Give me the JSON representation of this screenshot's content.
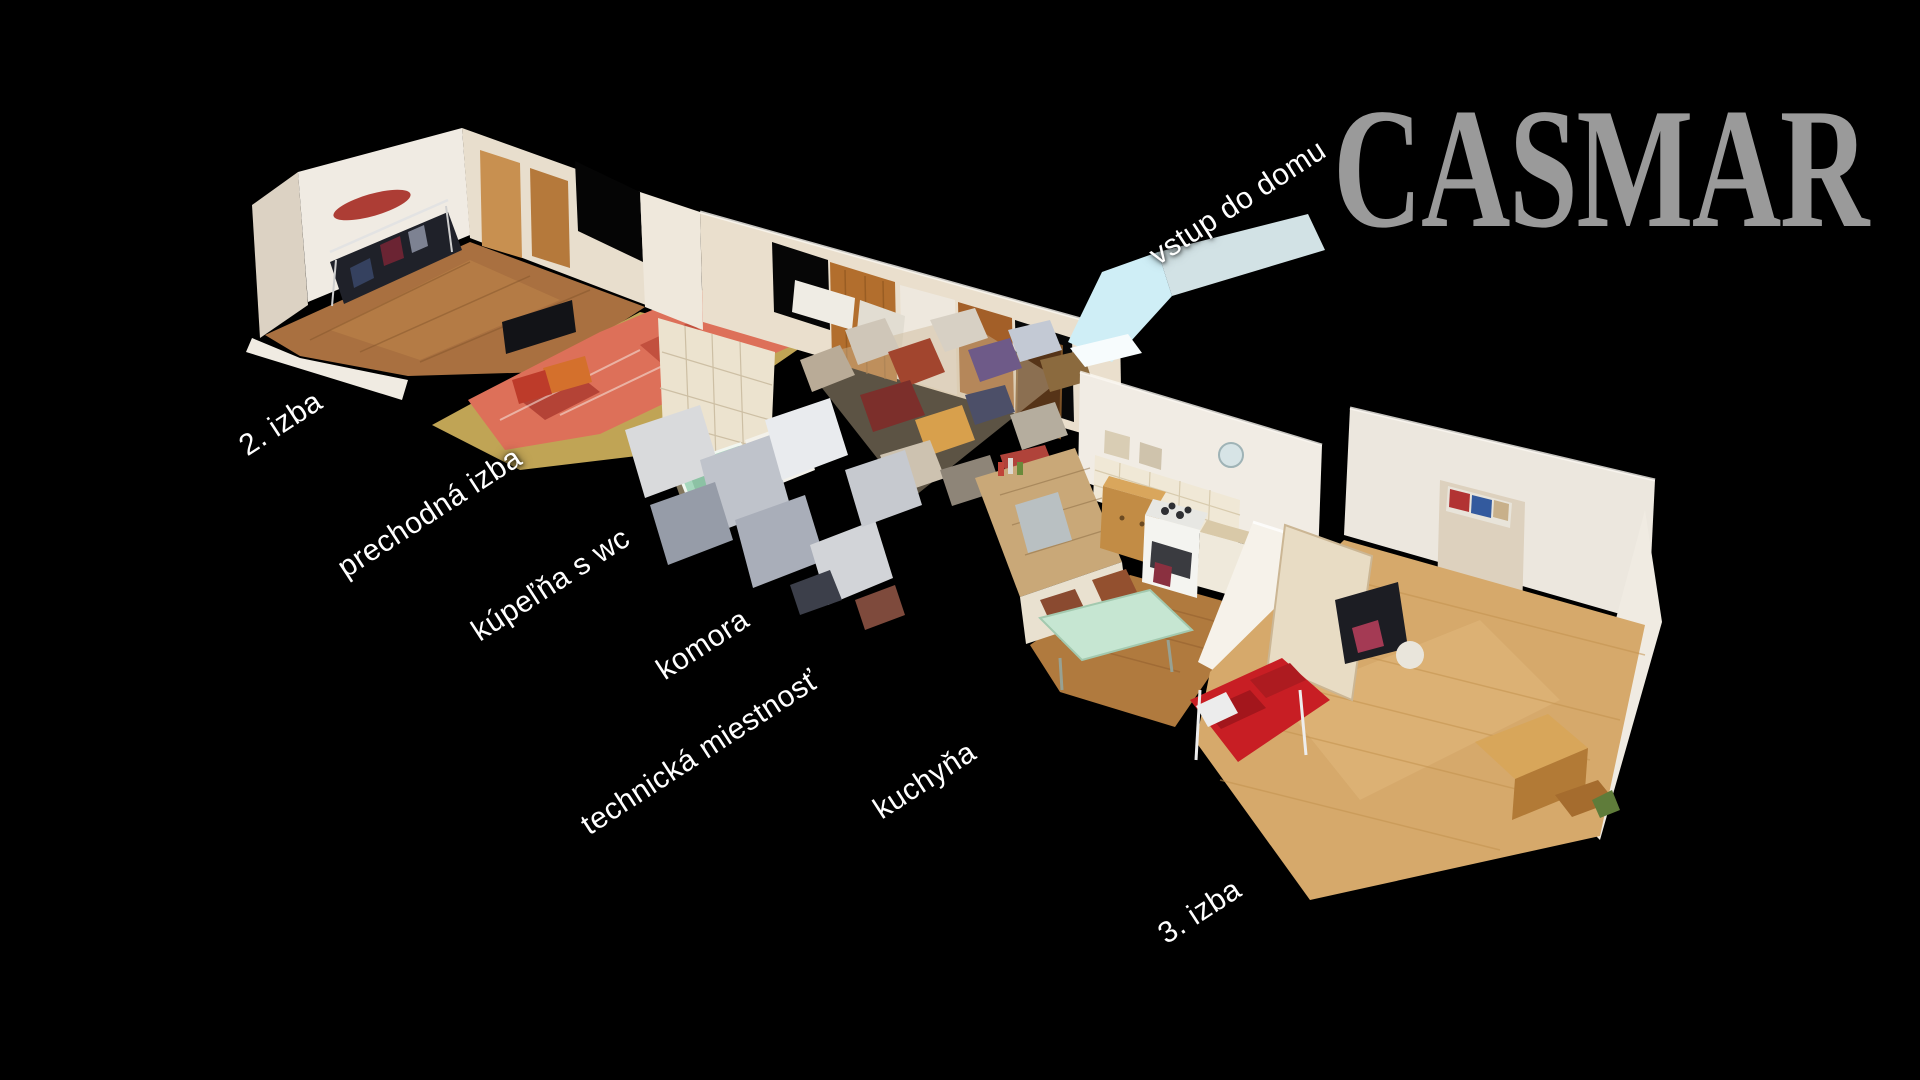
{
  "background_color": "#000000",
  "brand": {
    "logo_text": "CASMAR",
    "logo_color": "#9a9a9a"
  },
  "floorplan": {
    "view": "3D dollhouse cutaway scan of a single-storey house",
    "entrance_label": "vstup do domu",
    "entrance_arrow_color": "#cfeef6",
    "rooms": [
      "2. izba",
      "prechodná izba",
      "kúpeľňa s wc",
      "komora",
      "technická miestnosť",
      "kuchyňa",
      "3. izba"
    ]
  },
  "labels": [
    {
      "id": "room-2",
      "text": "2. izba"
    },
    {
      "id": "prechodna-izba",
      "text": "prechodná izba"
    },
    {
      "id": "kupelna-s-wc",
      "text": "kúpeľňa s wc"
    },
    {
      "id": "komora",
      "text": "komora"
    },
    {
      "id": "technicka-miestnost",
      "text": "technická miestnosť"
    },
    {
      "id": "kuchyna",
      "text": "kuchyňa"
    },
    {
      "id": "room-3",
      "text": "3. izba"
    },
    {
      "id": "vstup-do-domu",
      "text": "vstup do domu"
    }
  ]
}
